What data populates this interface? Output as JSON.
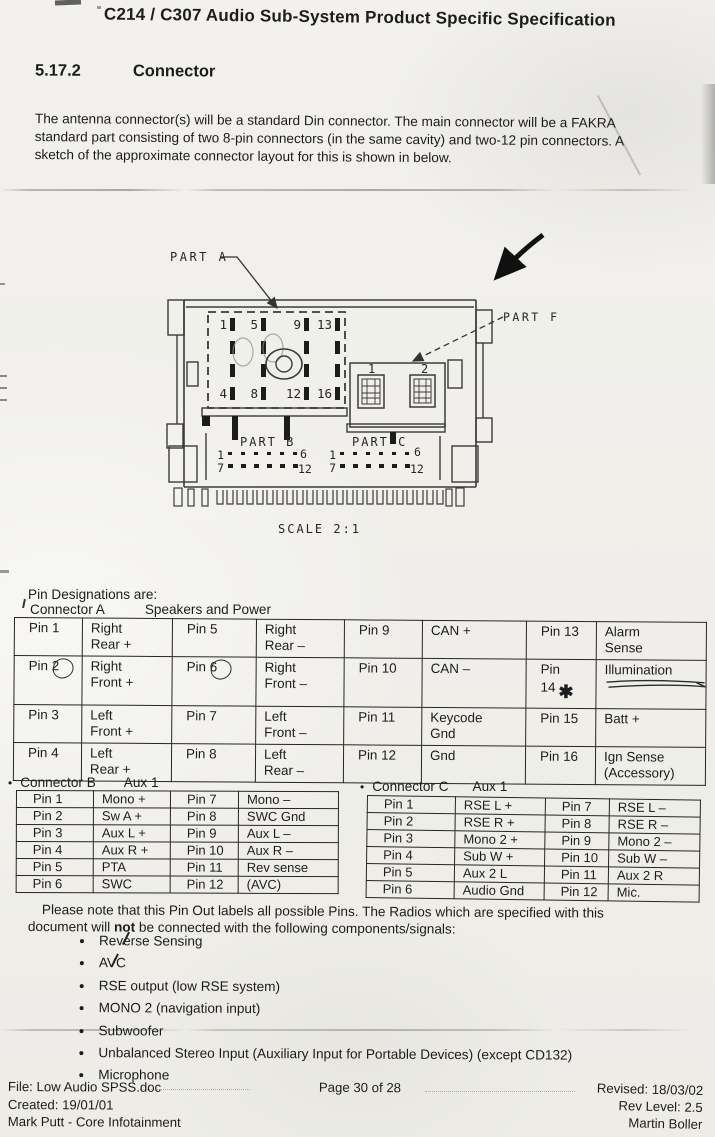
{
  "header": {
    "title": "C214 / C307 Audio Sub-System Product Specific Specification"
  },
  "section": {
    "number": "5.17.2",
    "heading": "Connector",
    "intro_lines": [
      "The antenna connector(s) will be a standard Din connector. The main connector will be a FAKRA",
      "standard part consisting of two 8-pin connectors (in the same cavity) and two-12 pin connectors. A",
      "sketch of the approximate connector layout for this is shown in below."
    ]
  },
  "diagram": {
    "part_a_label": "PART A",
    "part_f_label": "PART F",
    "part_b_label": "PART B",
    "part_c_label": "PART C",
    "scale_label": "SCALE 2:1",
    "part_a_pin_numbers_top": [
      "1",
      "5",
      "9",
      "13"
    ],
    "part_a_pin_numbers_bottom": [
      "4",
      "8",
      "12",
      "16"
    ],
    "part_f_pin_numbers": [
      "1",
      "2"
    ],
    "part_b_row1": {
      "start": "1",
      "end": "6"
    },
    "part_b_row2": {
      "start": "7",
      "end": "12"
    },
    "part_c_row1": {
      "start": "1",
      "end": "6"
    },
    "part_c_row2": {
      "start": "7",
      "end": "12"
    }
  },
  "pin_designations": {
    "heading": "Pin Designations are:",
    "connector_a": {
      "title": "Connector A",
      "subtitle": "Speakers and Power",
      "rows": [
        [
          "Pin 1",
          "Right\nRear +",
          "Pin 5",
          "Right\nRear –",
          "Pin 9",
          "CAN +",
          "Pin 13",
          "Alarm\nSense"
        ],
        [
          "Pin 2",
          "Right\nFront +",
          "Pin 6",
          "Right\nFront –",
          "Pin 10",
          "CAN –",
          "Pin 14",
          "Illumination"
        ],
        [
          "Pin 3",
          "Left\nFront +",
          "Pin 7",
          "Left\nFront –",
          "Pin 11",
          "Keycode\nGnd",
          "Pin 15",
          "Batt +"
        ],
        [
          "Pin 4",
          "Left\nRear +",
          "Pin 8",
          "Left\nRear –",
          "Pin 12",
          "Gnd",
          "Pin 16",
          "Ign Sense\n(Accessory)"
        ]
      ],
      "annotations": {
        "footnote_mark": "✱"
      }
    },
    "connector_b": {
      "bullet": "•",
      "title": "Connector B",
      "subtitle": "Aux 1",
      "rows": [
        [
          "Pin 1",
          "Mono +",
          "Pin 7",
          "Mono –"
        ],
        [
          "Pin 2",
          "Sw A +",
          "Pin 8",
          "SWC Gnd"
        ],
        [
          "Pin 3",
          "Aux L +",
          "Pin 9",
          "Aux L –"
        ],
        [
          "Pin 4",
          "Aux R +",
          "Pin 10",
          "Aux R –"
        ],
        [
          "Pin 5",
          "PTA",
          "Pin 11",
          "Rev sense"
        ],
        [
          "Pin 6",
          "SWC",
          "Pin 12",
          "(AVC)"
        ]
      ]
    },
    "connector_c": {
      "bullet": "•",
      "title": "Connector C",
      "subtitle": "Aux 1",
      "rows": [
        [
          "Pin 1",
          "RSE L +",
          "Pin 7",
          "RSE L –"
        ],
        [
          "Pin 2",
          "RSE R +",
          "Pin 8",
          "RSE R –"
        ],
        [
          "Pin 3",
          "Mono 2 +",
          "Pin 9",
          "Mono 2 –"
        ],
        [
          "Pin 4",
          "Sub W +",
          "Pin 10",
          "Sub W –"
        ],
        [
          "Pin 5",
          "Aux 2 L",
          "Pin 11",
          "Aux 2 R"
        ],
        [
          "Pin 6",
          "Audio Gnd",
          "Pin 12",
          "Mic."
        ]
      ]
    }
  },
  "note": {
    "line1": "Please note that this Pin Out labels all possible Pins. The Radios which are specified with this",
    "line2_pre": "document will ",
    "line2_bold": "not",
    "line2_post": " be connected with the following components/signals:",
    "items": [
      "Reverse Sensing",
      "AVC",
      "RSE output (low RSE system)",
      "MONO 2 (navigation input)",
      "Subwoofer",
      "Unbalanced Stereo Input (Auxiliary Input for Portable Devices) (except CD132)",
      "Microphone"
    ]
  },
  "footer": {
    "file": "File: Low Audio SPSS.doc",
    "created": "Created: 19/01/01",
    "author": "Mark Putt - Core Infotainment",
    "page": "Page 30 of 28",
    "revised": "Revised: 18/03/02",
    "rev_level": "Rev Level: 2.5",
    "reviser": "Martin Boller"
  }
}
